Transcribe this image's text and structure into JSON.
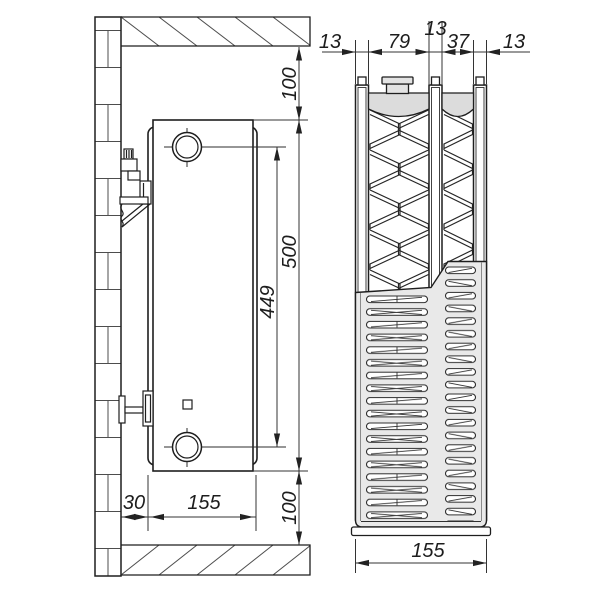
{
  "drawing_type": "radiator-technical-drawing",
  "side_view": {
    "top_clearance": "100",
    "height": "500",
    "connection_spacing": "449",
    "bottom_clearance": "100",
    "wall_clearance": "30",
    "depth": "155"
  },
  "section_view": {
    "front_panel": "13",
    "wide_channel": "79",
    "middle_panel": "13",
    "narrow_channel": "37",
    "back_panel": "13",
    "width": "155"
  },
  "colors": {
    "line": "#1e1e1e",
    "dim_line": "#333333",
    "header_fill": "#dcdcdc",
    "grille_fill": "#e9e9e9",
    "plug_fill": "#e3e3e3",
    "background": "#ffffff"
  }
}
